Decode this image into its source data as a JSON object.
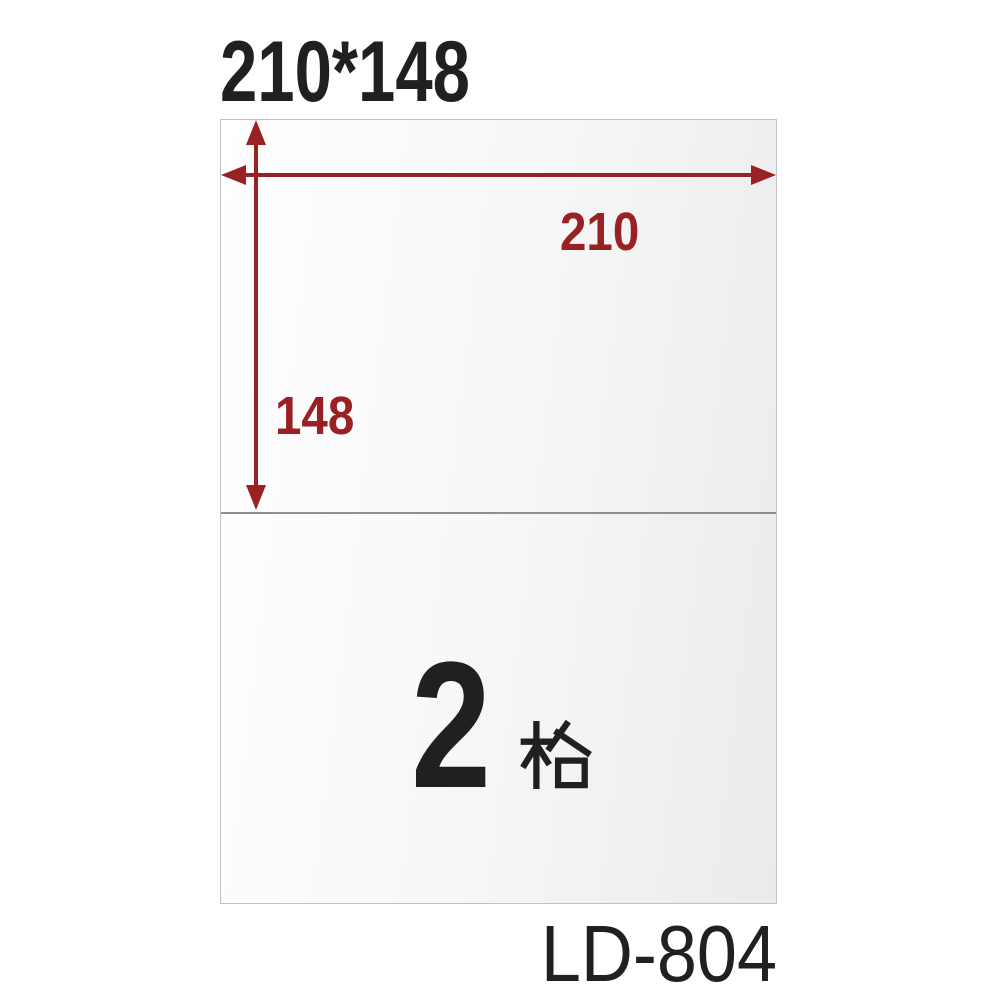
{
  "header": {
    "size_title": "210*148"
  },
  "sheet": {
    "width_label": "210",
    "height_label": "148",
    "cell_count": "2",
    "cell_unit": "格",
    "cell_label": "2格"
  },
  "footer": {
    "model_number": "LD-804"
  },
  "icons": {
    "width_arrow": "double-headed-horizontal-dimension-arrow",
    "height_arrow": "double-headed-vertical-dimension-arrow"
  },
  "colors": {
    "dimension_red": "#9a2123",
    "ink_black": "#202023",
    "sheet_border": "#c2c2c5",
    "divider_gray": "#8e8e93",
    "canvas_bg": "#ffffff"
  }
}
